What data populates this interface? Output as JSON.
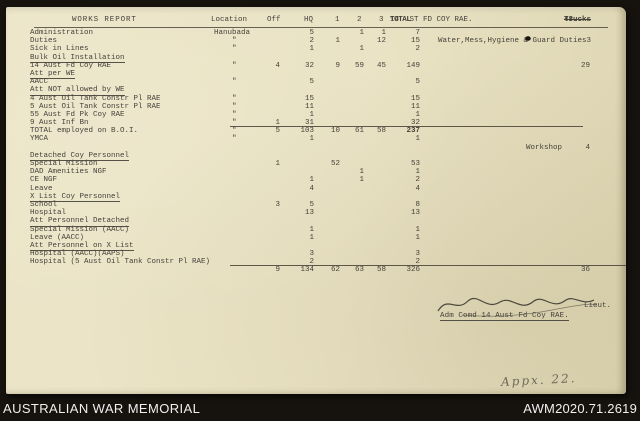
{
  "colors": {
    "paper": "#e9e2c3",
    "ink": "#45413a",
    "background": "#16130e",
    "footer_text": "#efefef"
  },
  "document": {
    "header": {
      "title": "WORKS REPORT",
      "location": "Location",
      "off": "Off",
      "hq": "HQ",
      "c1": "1",
      "c2": "2",
      "c3": "3",
      "total_prefix": "14",
      "total_over": "TOTAL",
      "total_suffix": "ST FD COY RAE.",
      "far_bold": "Trucks",
      "far_rest": "43."
    },
    "signature": {
      "rank": "Lieut.",
      "role": "Adm Comd 14 Aust Fd Coy RAE."
    },
    "annotation": "Appx. 22."
  },
  "table": {
    "columns": [
      "label",
      "loc",
      "off",
      "hq",
      "n1",
      "n2",
      "n3",
      "tot",
      "note",
      "far"
    ],
    "rows": [
      {
        "label": "Administration",
        "loc": "Hanubada",
        "hq": "5",
        "n2": "1",
        "n3": "1",
        "tot": "7"
      },
      {
        "label": "Duties",
        "loc": "\"",
        "hq": "2",
        "n1": "1",
        "n3": "12",
        "tot": "15",
        "note": "Water,Mess,Hygiene & Guard Duties3"
      },
      {
        "label": "Sick in Lines",
        "loc": "\"",
        "hq": "1",
        "n2": "1",
        "tot": "2"
      },
      {
        "label": "Bulk Oil Installation",
        "u": true
      },
      {
        "label": "14 Aust Fd Coy RAE",
        "loc": "\"",
        "off": "4",
        "hq": "32",
        "n1": "9",
        "n2": "59",
        "n3": "45",
        "tot": "149",
        "far": "29"
      },
      {
        "label": "Att per WE",
        "u": true
      },
      {
        "label": "AACC",
        "loc": "\"",
        "hq": "5",
        "tot": "5"
      },
      {
        "label": "Att NOT allowed by WE",
        "u": true
      },
      {
        "label": "4 Aust Oil Tank Constr Pl RAE",
        "loc": "\"",
        "hq": "15",
        "tot": "15"
      },
      {
        "label": "5 Aust Oil Tank Constr Pl RAE",
        "loc": "\"",
        "hq": "11",
        "tot": "11"
      },
      {
        "label": "55 Aust Fd Pk Coy RAE",
        "loc": "\"",
        "hq": "1",
        "tot": "1"
      },
      {
        "label": "9 Aust Inf Bn",
        "loc": "\"",
        "off": "1",
        "hq": "31",
        "tot": "32"
      },
      {
        "label": "TOTAL employed on B.O.I.",
        "loc": "\"",
        "off": "5",
        "hq": "103",
        "n1": "10",
        "n2": "61",
        "n3": "58",
        "tot": "237",
        "rule": "mid",
        "totBold": true
      },
      {
        "label": "YMCA",
        "loc": "\"",
        "hq": "1",
        "tot": "1"
      },
      {
        "note": "Workshop",
        "noteRight": true,
        "far": "4"
      },
      {
        "label": "Detached Coy Personnel",
        "u": true
      },
      {
        "label": "Special Mission",
        "off": "1",
        "n1": "52",
        "tot": "53"
      },
      {
        "label": "DAD Amenities NGF",
        "n2": "1",
        "tot": "1"
      },
      {
        "label": "CE NGF",
        "hq": "1",
        "n2": "1",
        "tot": "2"
      },
      {
        "label": "Leave",
        "hq": "4",
        "tot": "4"
      },
      {
        "label": "X List Coy Personnel",
        "u": true
      },
      {
        "label": "School",
        "off": "3",
        "hq": "5",
        "tot": "8"
      },
      {
        "label": "Hospital",
        "hq": "13",
        "tot": "13"
      },
      {
        "label": "Att Personnel Detached",
        "u": true
      },
      {
        "label": "Special Mission (AACC)",
        "hq": "1",
        "tot": "1"
      },
      {
        "label": "Leave (AACC)",
        "hq": "1",
        "tot": "1"
      },
      {
        "label": "Att Personnel on X List",
        "u": true
      },
      {
        "label": "Hospital (AACC)(AAPS)",
        "hq": "3",
        "tot": "3"
      },
      {
        "label": "Hospital (5 Aust Oil Tank Constr Pl RAE)",
        "hq": "2",
        "tot": "2"
      },
      {
        "off": "9",
        "hq": "134",
        "n1": "62",
        "n2": "63",
        "n3": "58",
        "tot": "326",
        "far": "36",
        "rule": "full"
      }
    ]
  },
  "footer": {
    "left": "AUSTRALIAN WAR MEMORIAL",
    "right": "AWM2020.71.2619"
  }
}
